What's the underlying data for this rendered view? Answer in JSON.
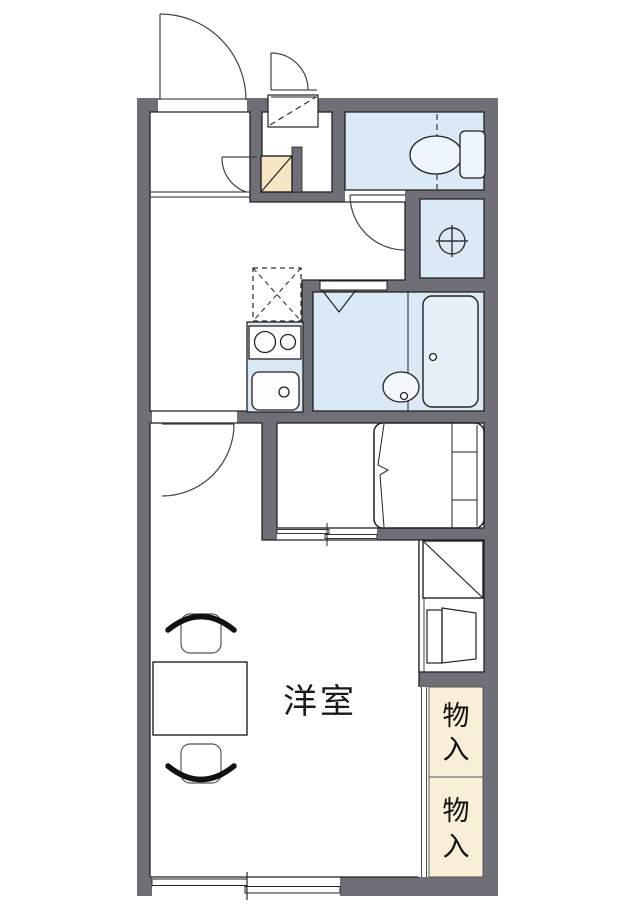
{
  "floorplan": {
    "labels": {
      "main_room": "洋室",
      "storage_upper_char1": "物",
      "storage_upper_char2": "入",
      "storage_lower_char1": "物",
      "storage_lower_char2": "入"
    },
    "colors": {
      "wall": "#6f6f78",
      "wet_area_fill": "#dbe8f5",
      "storage_fill": "#f9eed6",
      "cabinet_fill": "#f7e5c4",
      "floor_fill": "#ffffff",
      "line": "#222222"
    },
    "fixtures": [
      "entrance-door",
      "outdoor-storage-door",
      "overhead-cabinet",
      "shoe-cabinet",
      "toilet",
      "washing-machine-pan",
      "refrigerator-space",
      "stove",
      "kitchen-sink",
      "folding-bath-door",
      "wash-basin",
      "bathtub",
      "bed",
      "sliding-door",
      "closet",
      "shelf-unit",
      "storage-upper",
      "storage-lower",
      "table",
      "chair",
      "balcony-window"
    ]
  }
}
